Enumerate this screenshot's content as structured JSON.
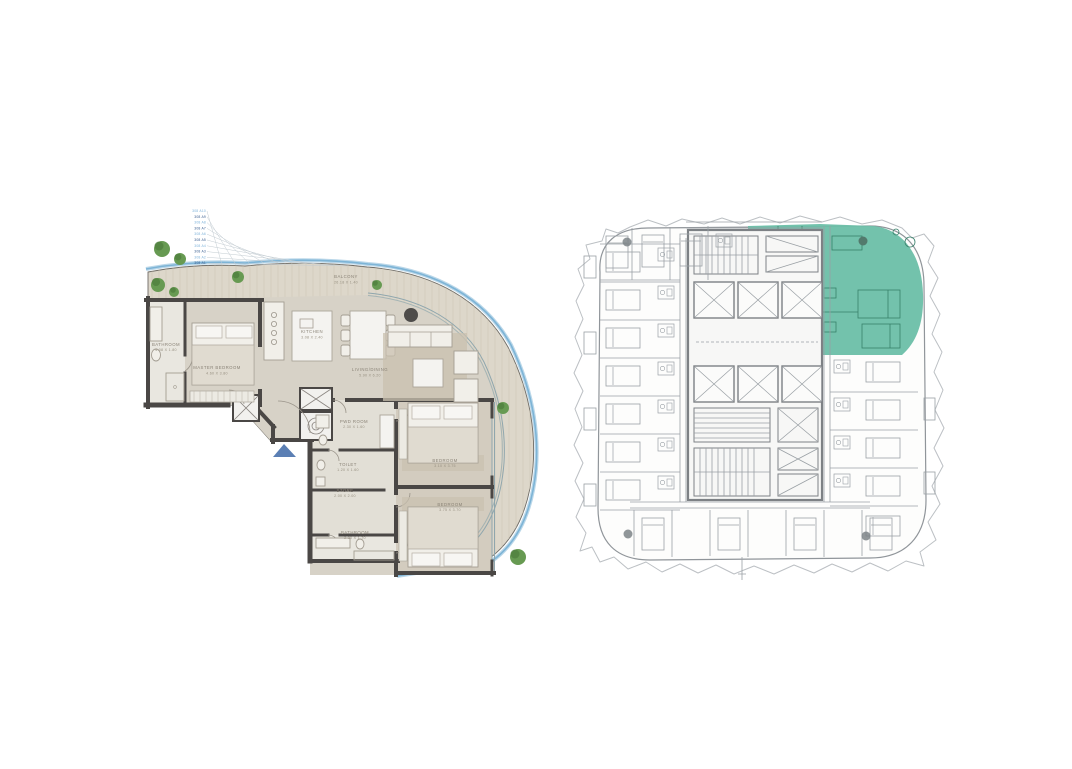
{
  "canvas": {
    "width": 1072,
    "height": 769,
    "background": "#ffffff"
  },
  "apartment_plan": {
    "unit_codes": [
      "308 A10",
      "308 A9",
      "308 A8",
      "308 A7",
      "308 A6",
      "308 A5",
      "308 A4",
      "308 A3",
      "308 A2",
      "308 A1"
    ],
    "rooms": {
      "bathroom_master": {
        "label": "BATHROOM",
        "dims": "4.08 X 1.80"
      },
      "master_bedroom": {
        "label": "MASTER BEDROOM",
        "dims": "4.60 X 3.80"
      },
      "kitchen": {
        "label": "KITCHEN",
        "dims": "3.08 X 2.40"
      },
      "balcony": {
        "label": "BALCONY",
        "dims": "26.18 X 1.40"
      },
      "living_dining": {
        "label": "LIVING/DINING",
        "dims": "5.90 X 6.20"
      },
      "pwd_room": {
        "label": "PWD ROOM",
        "dims": "2.30 X 1.60"
      },
      "toilet": {
        "label": "TOILET",
        "dims": "1.20 X 1.60"
      },
      "store": {
        "label": "STORE",
        "dims": "2.00 X 2.00"
      },
      "bedroom_2": {
        "label": "BEDROOM",
        "dims": "3.10 X 3.75"
      },
      "bedroom_3": {
        "label": "BEDROOM",
        "dims": "3.75 X 3.70"
      },
      "bathroom_2": {
        "label": "BATHROOM",
        "dims": "2.30 X 1.70"
      }
    },
    "colors": {
      "wall": "#4a4745",
      "deck": "#ddd7ca",
      "floor": "#d7d2c7",
      "tile": "#e9e7e0",
      "water_line": "#7db4d6",
      "tree": "#679a52",
      "entry_marker": "#5b7fb4",
      "label_text": "#8a8377",
      "unit_code_text": "#3b5f90"
    }
  },
  "key_plan": {
    "highlight_color": "#6cbfa8",
    "highlight_line_color": "#38806a",
    "line_color": "#9aa0a5",
    "core_color": "#7d8185",
    "outline_color": "#bcc0c4"
  }
}
